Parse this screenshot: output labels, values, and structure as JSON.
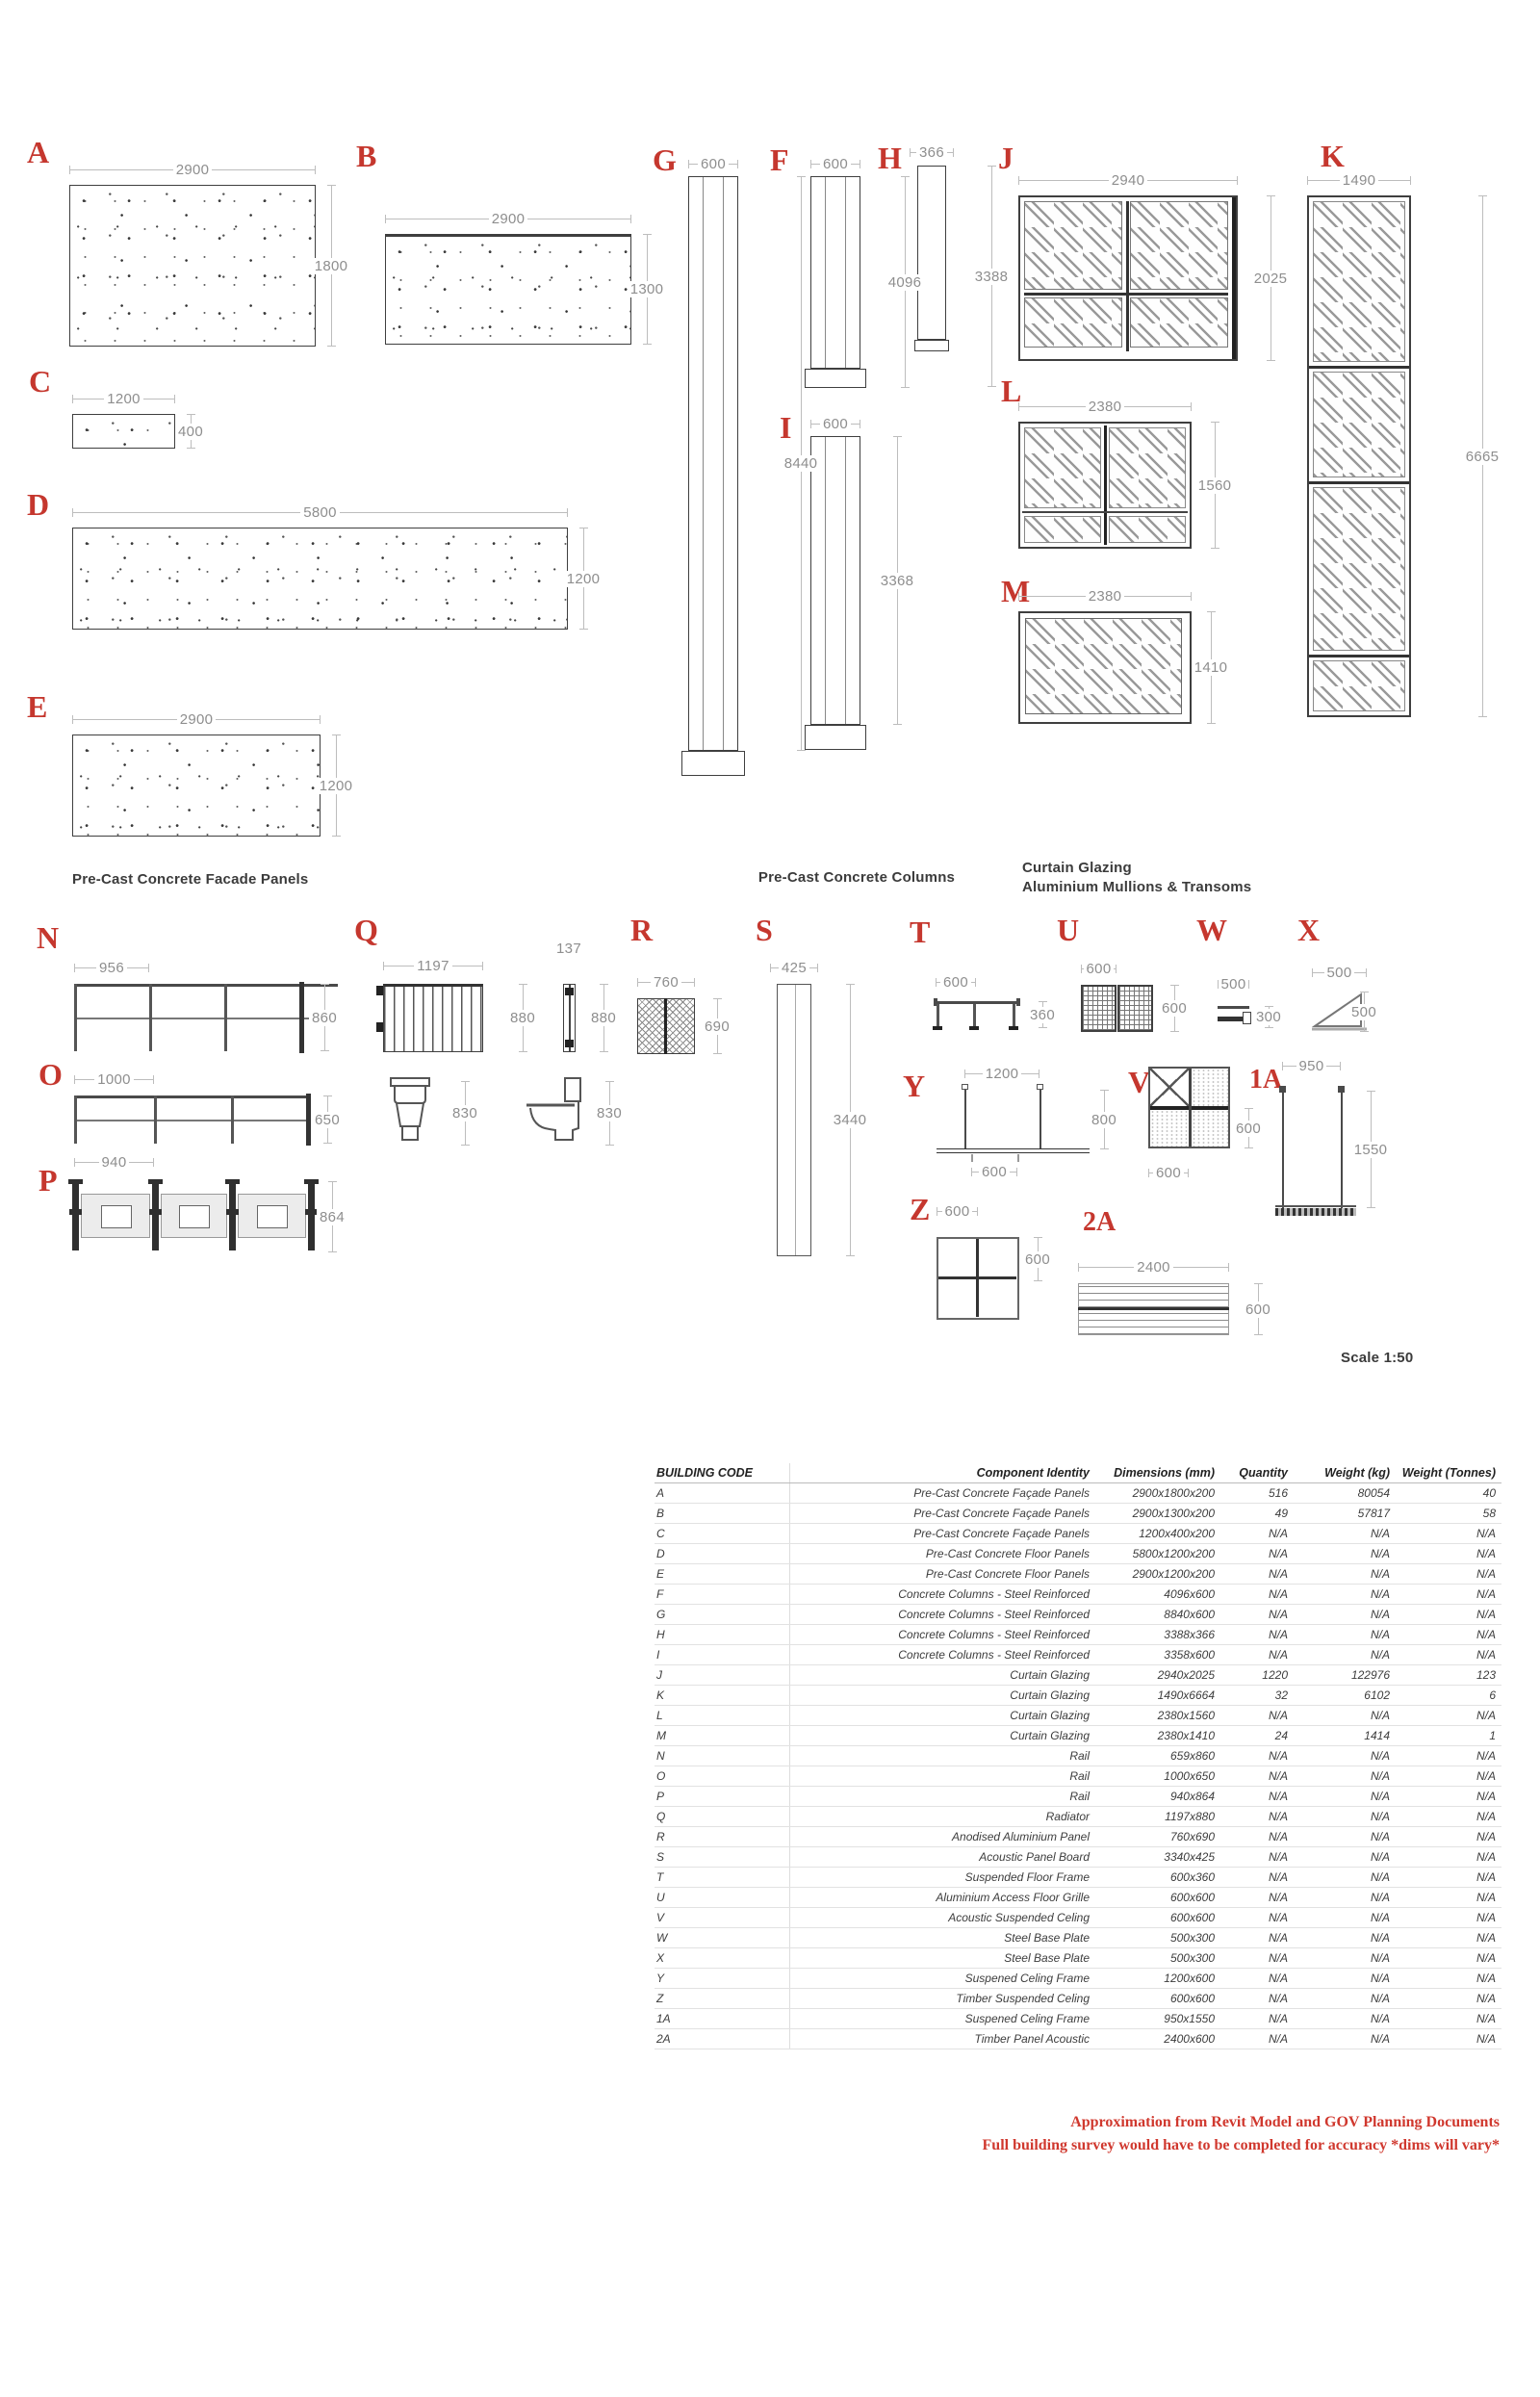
{
  "sheet": {
    "scale": "Scale 1:50",
    "captions": {
      "facade": "Pre-Cast Concrete Facade Panels",
      "columns": "Pre-Cast Concrete Columns",
      "glazing1": "Curtain Glazing",
      "glazing2": "Aluminium Mullions & Transoms"
    },
    "footnote1": "Approximation from Revit Model and GOV Planning Documents",
    "footnote2": "Full building survey would have to be completed for accuracy *dims will vary*",
    "colors": {
      "code_red": "#c5372e",
      "dim_gray": "#8e8e8e",
      "line_dark": "#3f3f3f",
      "footnote_red": "#d0382e"
    }
  },
  "diagrams": {
    "A": {
      "code": "A",
      "top": "2900",
      "right": "1800"
    },
    "B": {
      "code": "B",
      "top": "2900",
      "right": "1300"
    },
    "C": {
      "code": "C",
      "top": "1200",
      "right": "400"
    },
    "D": {
      "code": "D",
      "top": "5800",
      "right": "1200"
    },
    "E": {
      "code": "E",
      "top": "2900",
      "right": "1200"
    },
    "F": {
      "code": "F",
      "top": "600",
      "right": "4096"
    },
    "G": {
      "code": "G",
      "top": "600",
      "right": "8440"
    },
    "H": {
      "code": "H",
      "top": "366",
      "right": "3388"
    },
    "I": {
      "code": "I",
      "top": "600",
      "right": "3368"
    },
    "J": {
      "code": "J",
      "top": "2940",
      "right": "2025"
    },
    "K": {
      "code": "K",
      "top": "1490",
      "right": "6665"
    },
    "L": {
      "code": "L",
      "top": "2380",
      "right": "1560"
    },
    "M": {
      "code": "M",
      "top": "2380",
      "right": "1410"
    },
    "N": {
      "code": "N",
      "top": "956",
      "right": "860"
    },
    "O": {
      "code": "O",
      "top": "1000",
      "right": "650"
    },
    "P": {
      "code": "P",
      "top": "940",
      "right": "864"
    },
    "Q": {
      "code": "Q",
      "front_top": "1197",
      "front_right": "880",
      "side_top": "137",
      "side_right": "880",
      "wc_front": "830",
      "wc_side": "830"
    },
    "R": {
      "code": "R",
      "top": "760",
      "right": "690"
    },
    "S": {
      "code": "S",
      "top": "425",
      "right": "3440"
    },
    "T": {
      "code": "T",
      "top": "600",
      "right": "360"
    },
    "U": {
      "code": "U",
      "top": "600",
      "right": "600"
    },
    "V": {
      "code": "V",
      "right": "600",
      "bottom": "600"
    },
    "W": {
      "code": "W",
      "top": "500",
      "right": "300"
    },
    "X": {
      "code": "X",
      "top": "500",
      "right": "500"
    },
    "Y": {
      "code": "Y",
      "top": "1200",
      "right": "800",
      "bottom": "600"
    },
    "Z": {
      "code": "Z",
      "top": "600",
      "right": "600"
    },
    "1A": {
      "code": "1A",
      "top": "950",
      "right": "1550"
    },
    "2A": {
      "code": "2A",
      "top": "2400",
      "right": "600"
    }
  },
  "table": {
    "headers": [
      "BUILDING CODE",
      "Component Identity",
      "Dimensions (mm)",
      "Quantity",
      "Weight (kg)",
      "Weight (Tonnes)"
    ],
    "rows": [
      [
        "A",
        "Pre-Cast Concrete Façade Panels",
        "2900x1800x200",
        "516",
        "80054",
        "40"
      ],
      [
        "B",
        "Pre-Cast Concrete Façade Panels",
        "2900x1300x200",
        "49",
        "57817",
        "58"
      ],
      [
        "C",
        "Pre-Cast Concrete Façade Panels",
        "1200x400x200",
        "N/A",
        "N/A",
        "N/A"
      ],
      [
        "D",
        "Pre-Cast Concrete Floor Panels",
        "5800x1200x200",
        "N/A",
        "N/A",
        "N/A"
      ],
      [
        "E",
        "Pre-Cast Concrete Floor Panels",
        "2900x1200x200",
        "N/A",
        "N/A",
        "N/A"
      ],
      [
        "F",
        "Concrete Columns - Steel Reinforced",
        "4096x600",
        "N/A",
        "N/A",
        "N/A"
      ],
      [
        "G",
        "Concrete Columns - Steel Reinforced",
        "8840x600",
        "N/A",
        "N/A",
        "N/A"
      ],
      [
        "H",
        "Concrete Columns - Steel Reinforced",
        "3388x366",
        "N/A",
        "N/A",
        "N/A"
      ],
      [
        "I",
        "Concrete Columns - Steel Reinforced",
        "3358x600",
        "N/A",
        "N/A",
        "N/A"
      ],
      [
        "J",
        "Curtain Glazing",
        "2940x2025",
        "1220",
        "122976",
        "123"
      ],
      [
        "K",
        "Curtain Glazing",
        "1490x6664",
        "32",
        "6102",
        "6"
      ],
      [
        "L",
        "Curtain Glazing",
        "2380x1560",
        "N/A",
        "N/A",
        "N/A"
      ],
      [
        "M",
        "Curtain Glazing",
        "2380x1410",
        "24",
        "1414",
        "1"
      ],
      [
        "N",
        "Rail",
        "659x860",
        "N/A",
        "N/A",
        "N/A"
      ],
      [
        "O",
        "Rail",
        "1000x650",
        "N/A",
        "N/A",
        "N/A"
      ],
      [
        "P",
        "Rail",
        "940x864",
        "N/A",
        "N/A",
        "N/A"
      ],
      [
        "Q",
        "Radiator",
        "1197x880",
        "N/A",
        "N/A",
        "N/A"
      ],
      [
        "R",
        "Anodised Aluminium Panel",
        "760x690",
        "N/A",
        "N/A",
        "N/A"
      ],
      [
        "S",
        "Acoustic Panel Board",
        "3340x425",
        "N/A",
        "N/A",
        "N/A"
      ],
      [
        "T",
        "Suspended Floor Frame",
        "600x360",
        "N/A",
        "N/A",
        "N/A"
      ],
      [
        "U",
        "Aluminium Access Floor Grille",
        "600x600",
        "N/A",
        "N/A",
        "N/A"
      ],
      [
        "V",
        "Acoustic Suspended Celing",
        "600x600",
        "N/A",
        "N/A",
        "N/A"
      ],
      [
        "W",
        "Steel Base Plate",
        "500x300",
        "N/A",
        "N/A",
        "N/A"
      ],
      [
        "X",
        "Steel Base Plate",
        "500x300",
        "N/A",
        "N/A",
        "N/A"
      ],
      [
        "Y",
        "Suspened Celing Frame",
        "1200x600",
        "N/A",
        "N/A",
        "N/A"
      ],
      [
        "Z",
        "Timber Suspended Celing",
        "600x600",
        "N/A",
        "N/A",
        "N/A"
      ],
      [
        "1A",
        "Suspened Celing Frame",
        "950x1550",
        "N/A",
        "N/A",
        "N/A"
      ],
      [
        "2A",
        "Timber Panel Acoustic",
        "2400x600",
        "N/A",
        "N/A",
        "N/A"
      ]
    ]
  }
}
